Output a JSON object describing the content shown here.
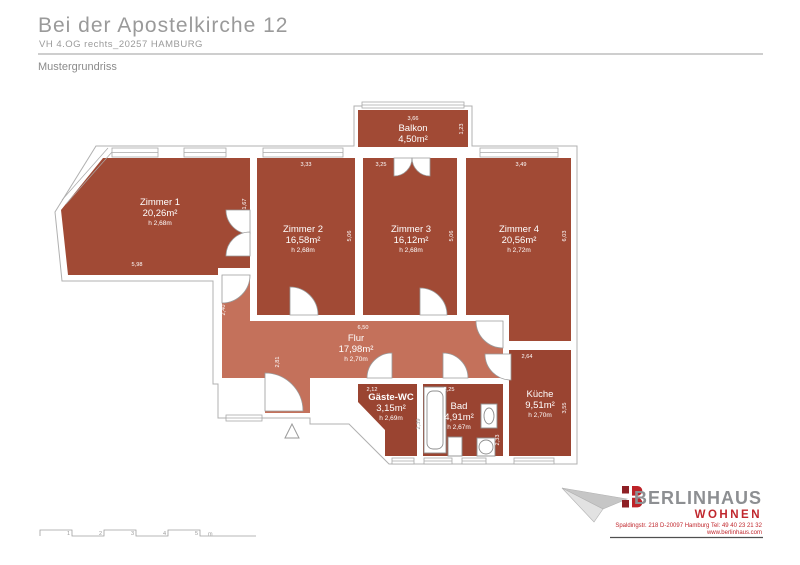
{
  "header": {
    "title": "Bei der Apostelkirche 12",
    "subtitle": "VH 4.OG rechts_20257 HAMBURG",
    "plan_label": "Mustergrundriss"
  },
  "plan": {
    "rooms": [
      {
        "name": "Zimmer 1",
        "area": "20,26m²",
        "height": "h 2,68m"
      },
      {
        "name": "Zimmer 2",
        "area": "16,58m²",
        "height": "h 2,68m"
      },
      {
        "name": "Zimmer 3",
        "area": "16,12m²",
        "height": "h 2,68m"
      },
      {
        "name": "Zimmer 4",
        "area": "20,56m²",
        "height": "h 2,72m"
      },
      {
        "name": "Balkon",
        "area": "4,50m²",
        "height": ""
      },
      {
        "name": "Flur",
        "area": "17,98m²",
        "height": "h 2,70m"
      },
      {
        "name": "Gäste-WC",
        "area": "3,15m²",
        "height": "h 2,69m"
      },
      {
        "name": "Bad",
        "area": "4,91m²",
        "height": "h 2,67m"
      },
      {
        "name": "Küche",
        "area": "9,51m²",
        "height": "h 2,70m"
      }
    ],
    "dims": {
      "d366": "3,66",
      "d123": "1,23",
      "d333": "3,33",
      "d325": "3,25",
      "d349": "3,49",
      "d167": "1,67",
      "d506a": "5,06",
      "d506b": "5,06",
      "d603": "6,03",
      "d598": "5,98",
      "d240": "2,40",
      "d650": "6,50",
      "d281": "2,81",
      "d212": "2,12",
      "d225": "2,25",
      "d264": "2,64",
      "d355": "3,55",
      "d239": "2,39",
      "d233": "2,33"
    },
    "scale": {
      "labels": [
        "1",
        "2",
        "3",
        "4",
        "5"
      ],
      "unit": "m"
    }
  },
  "footer": {
    "brand": "BERLINHAUS",
    "brand_sub": "WOHNEN",
    "address_line1": "Spaldingstr. 218 D-20097 Hamburg  Tel: 49 40 23 21 32",
    "address_line2": "www.berlinhaus.com"
  },
  "colors": {
    "room_dark": "#a14a35",
    "room_light": "#c4715b",
    "accent_red": "#c0272d",
    "brand_gray": "#8d8f92",
    "outline_gray": "#b0b0b0"
  }
}
